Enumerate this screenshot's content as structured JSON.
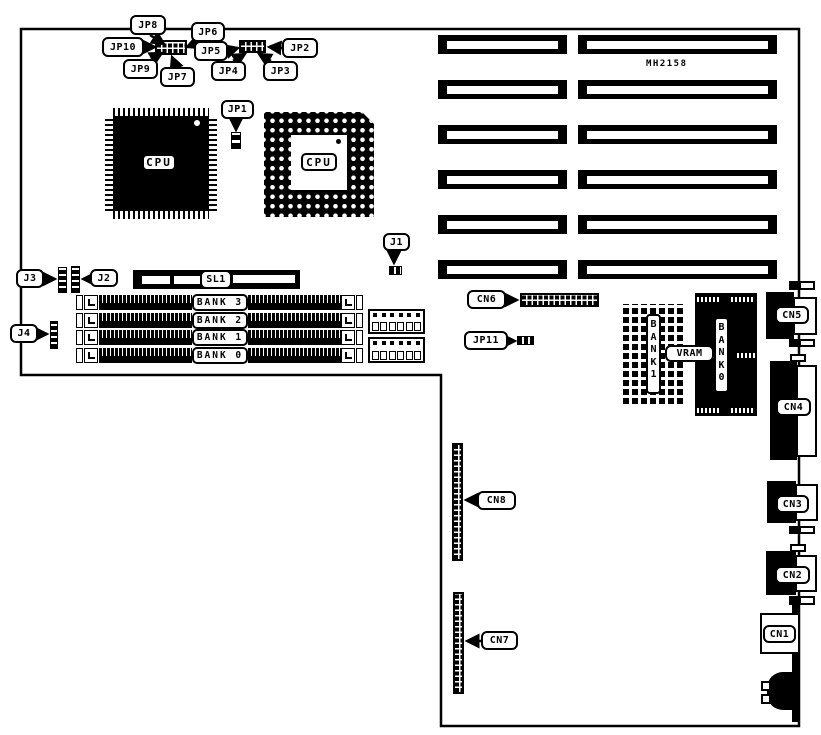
{
  "board": {
    "model": "MH2158"
  },
  "cpu": {
    "qfp_label": "CPU",
    "pga_label": "CPU"
  },
  "callouts": {
    "jp1": "JP1",
    "jp2": "JP2",
    "jp3": "JP3",
    "jp4": "JP4",
    "jp5": "JP5",
    "jp6": "JP6",
    "jp7": "JP7",
    "jp8": "JP8",
    "jp9": "JP9",
    "jp10": "JP10",
    "jp11": "JP11",
    "j1": "J1",
    "j2": "J2",
    "j3": "J3",
    "j4": "J4",
    "sl1": "SL1",
    "cn1": "CN1",
    "cn2": "CN2",
    "cn3": "CN3",
    "cn4": "CN4",
    "cn5": "CN5",
    "cn6": "CN6",
    "cn7": "CN7",
    "cn8": "CN8",
    "vram": "VRAM"
  },
  "memory": {
    "simm_banks": [
      "BANK 3",
      "BANK 2",
      "BANK 1",
      "BANK 0"
    ],
    "vram_bank_left": "BANK1",
    "vram_bank_right": "BANK0"
  },
  "expansion_slots": {
    "rows": 6,
    "columns": 2,
    "count": 12
  },
  "colors": {
    "ink": "#000000",
    "paper": "#ffffff"
  }
}
